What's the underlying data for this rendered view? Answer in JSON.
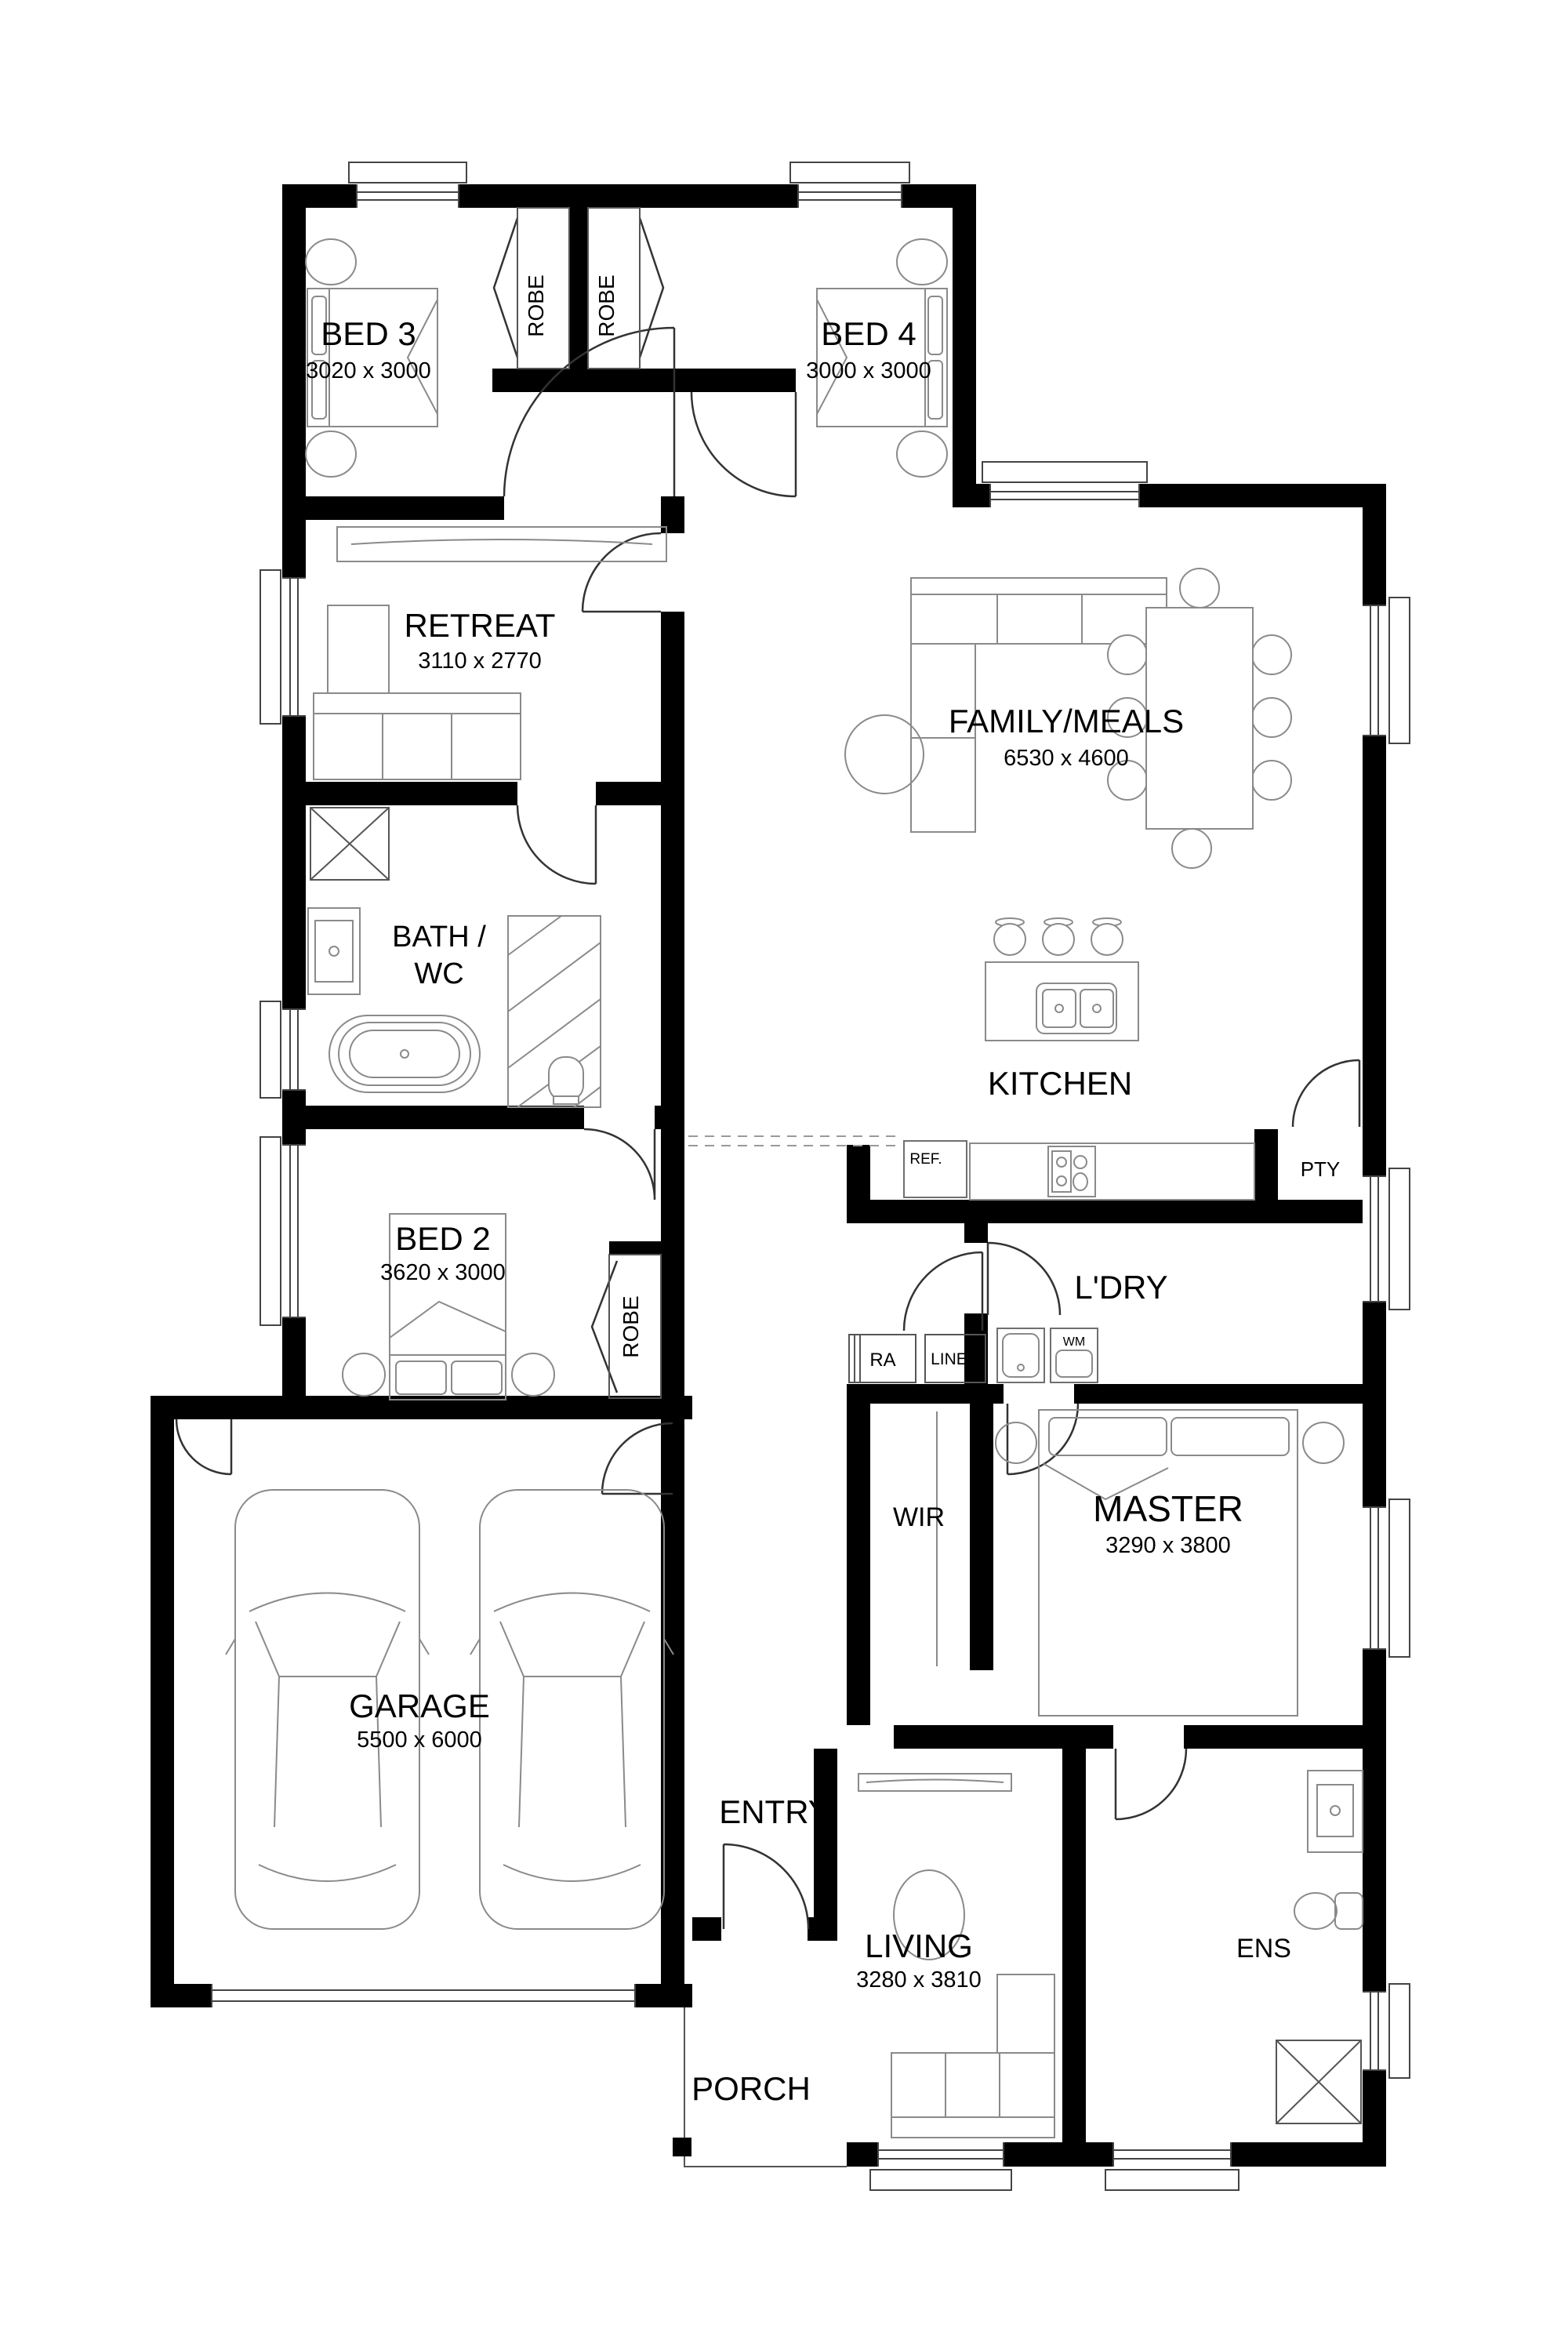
{
  "plan_title": "Single storey house floor plan",
  "rooms": {
    "bed3": {
      "name": "BED 3",
      "dims": "3020 x 3000"
    },
    "bed4": {
      "name": "BED 4",
      "dims": "3000 x 3000"
    },
    "retreat": {
      "name": "RETREAT",
      "dims": "3110 x 2770"
    },
    "family": {
      "name": "FAMILY/MEALS",
      "dims": "6530 x 4600"
    },
    "bath": {
      "line1": "BATH /",
      "line2": "WC"
    },
    "kitchen": {
      "name": "KITCHEN"
    },
    "bed2": {
      "name": "BED 2",
      "dims": "3620 x 3000"
    },
    "ldry": {
      "name": "L'DRY"
    },
    "wir": {
      "name": "WIR"
    },
    "master": {
      "name": "MASTER",
      "dims": "3290 x 3800"
    },
    "garage": {
      "name": "GARAGE",
      "dims": "5500 x 6000"
    },
    "entry": {
      "name": "ENTRY"
    },
    "living": {
      "name": "LIVING",
      "dims": "3280 x 3810"
    },
    "ens": {
      "name": "ENS"
    },
    "porch": {
      "name": "PORCH"
    }
  },
  "closets": {
    "robe": "ROBE",
    "linen": "LINEN",
    "pantry": "PTY",
    "ra": "RA"
  },
  "appliances": {
    "fridge": "REF.",
    "washer": "WM"
  },
  "colors": {
    "walls": "#000000",
    "fixtures": "#8a8a8a",
    "background": "#ffffff"
  }
}
